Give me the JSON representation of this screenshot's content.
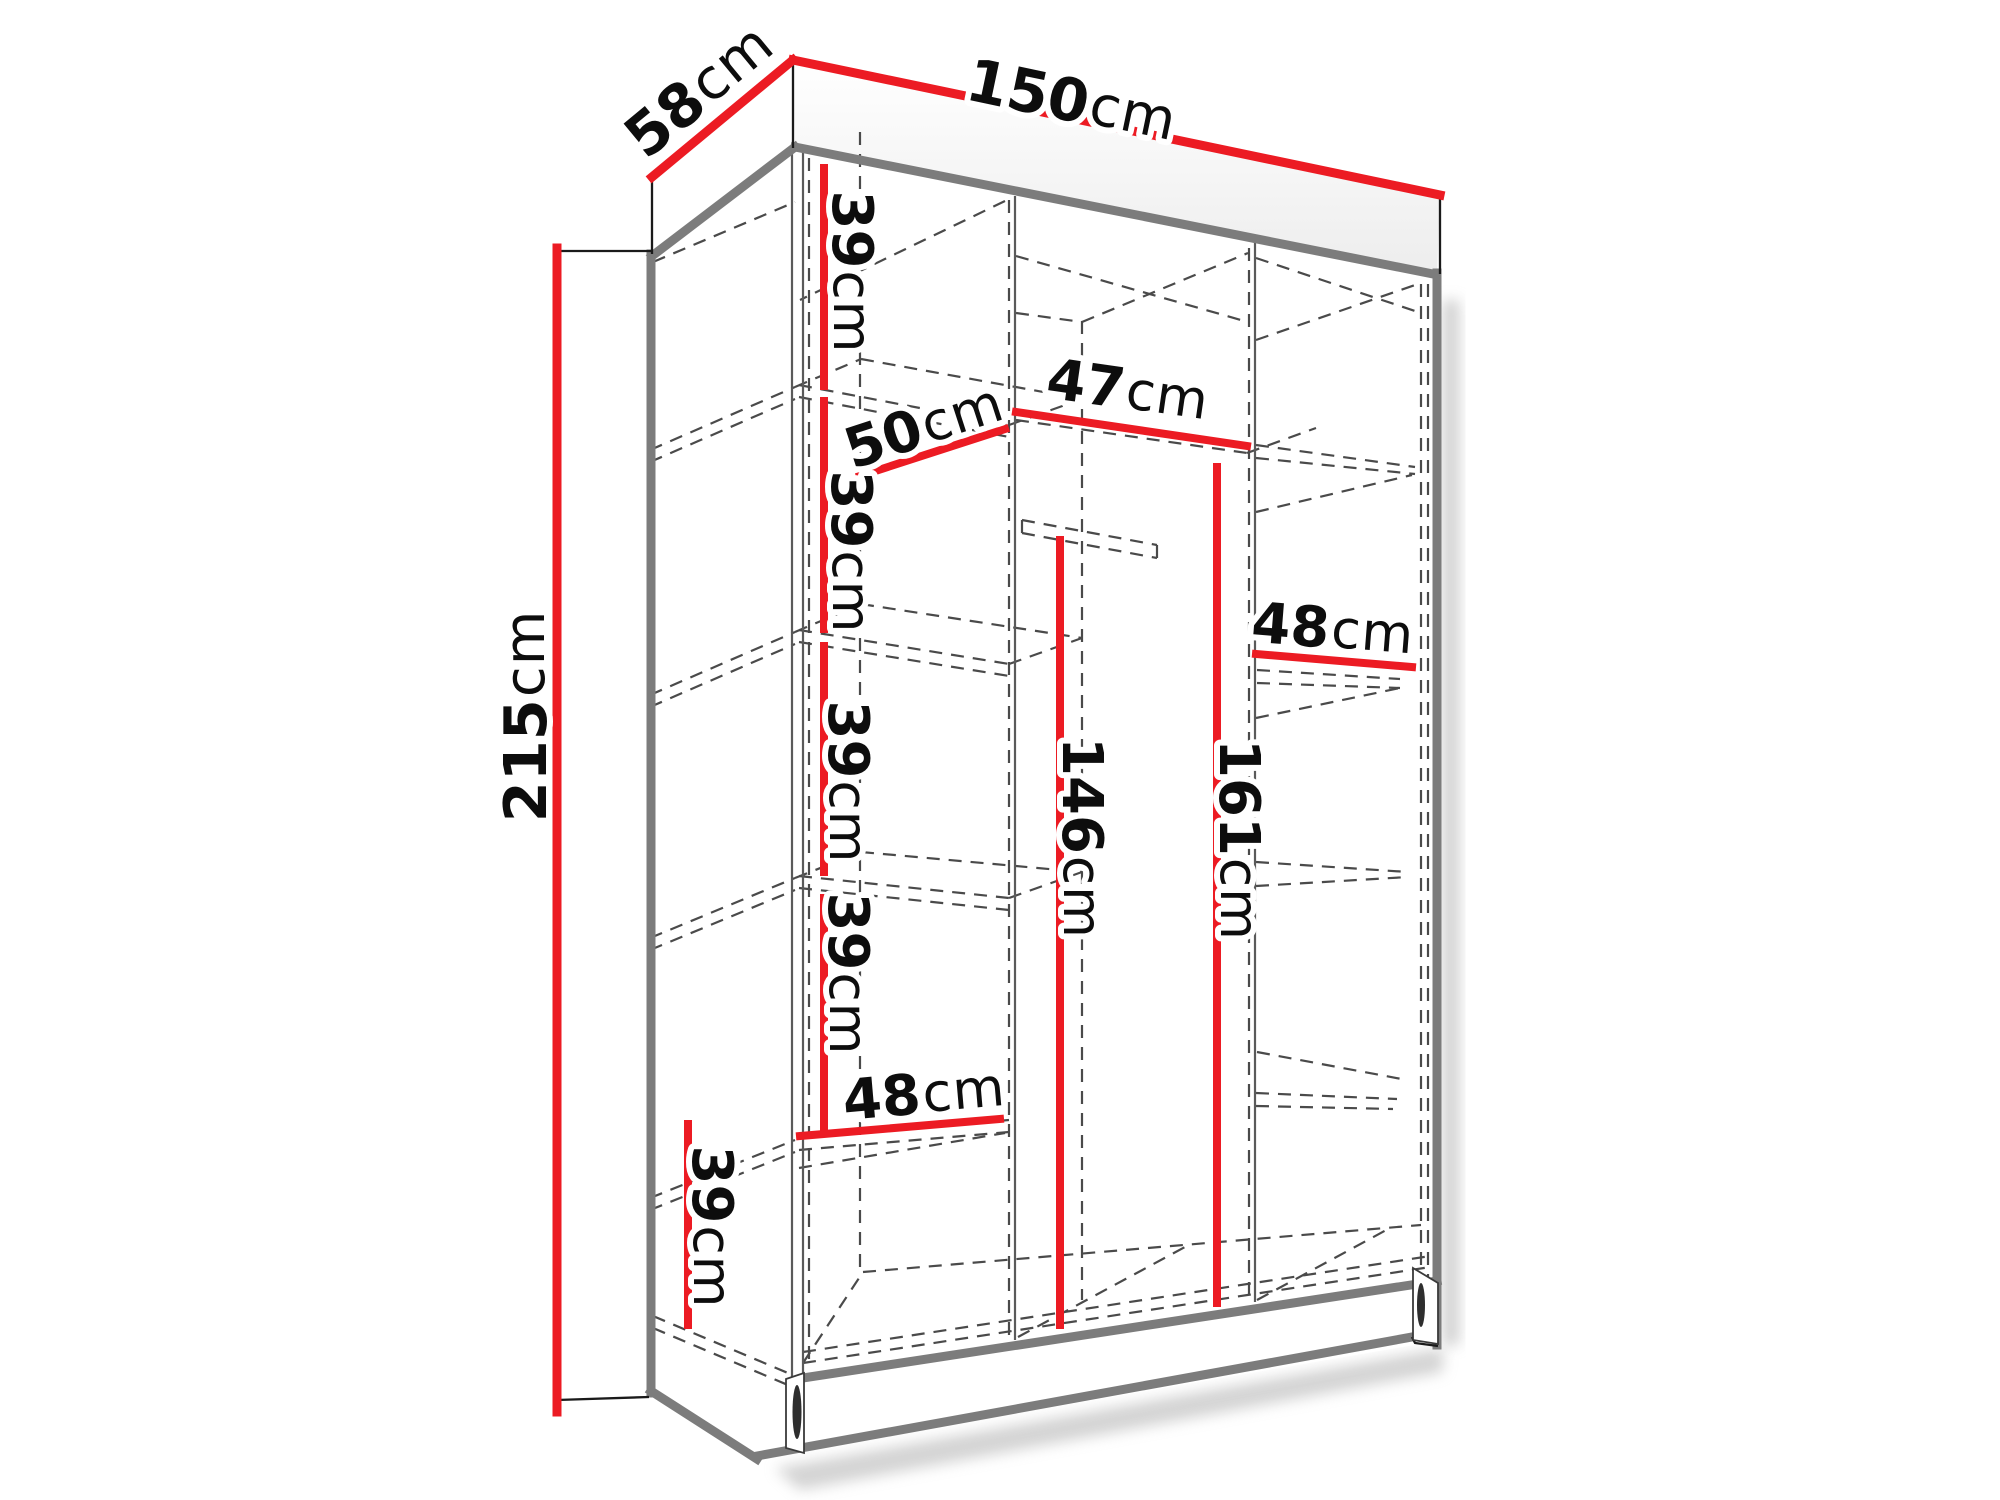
{
  "diagram": {
    "name": "wardrobe-dimension-diagram",
    "style": "3d-line-drawing",
    "unit": "cm",
    "colors": {
      "dimension_line": "#ec1b23",
      "structure_gray": "#7c7c7c",
      "hidden_dashed_line": "#4a4a4a",
      "outline_black": "#1a1a1a",
      "label_text": "#0d0d0d",
      "background": "#ffffff"
    },
    "overall": {
      "width_cm": "150",
      "depth_cm": "58",
      "height_cm": "215"
    },
    "labels": [
      {
        "id": "overall-width",
        "value": "150",
        "unit": "cm"
      },
      {
        "id": "overall-depth",
        "value": "58",
        "unit": "cm"
      },
      {
        "id": "overall-height",
        "value": "215",
        "unit": "cm"
      },
      {
        "id": "left-compartment-1-height",
        "value": "39",
        "unit": "cm"
      },
      {
        "id": "left-compartment-2-height",
        "value": "39",
        "unit": "cm"
      },
      {
        "id": "left-compartment-3-height",
        "value": "39",
        "unit": "cm"
      },
      {
        "id": "left-compartment-4-height",
        "value": "39",
        "unit": "cm"
      },
      {
        "id": "left-compartment-5-height",
        "value": "39",
        "unit": "cm"
      },
      {
        "id": "interior-depth",
        "value": "50",
        "unit": "cm"
      },
      {
        "id": "middle-section-width",
        "value": "47",
        "unit": "cm"
      },
      {
        "id": "right-section-width",
        "value": "48",
        "unit": "cm"
      },
      {
        "id": "right-hanging-height",
        "value": "161",
        "unit": "cm"
      },
      {
        "id": "middle-hanging-height",
        "value": "146",
        "unit": "cm"
      },
      {
        "id": "left-section-width",
        "value": "48",
        "unit": "cm"
      }
    ]
  }
}
